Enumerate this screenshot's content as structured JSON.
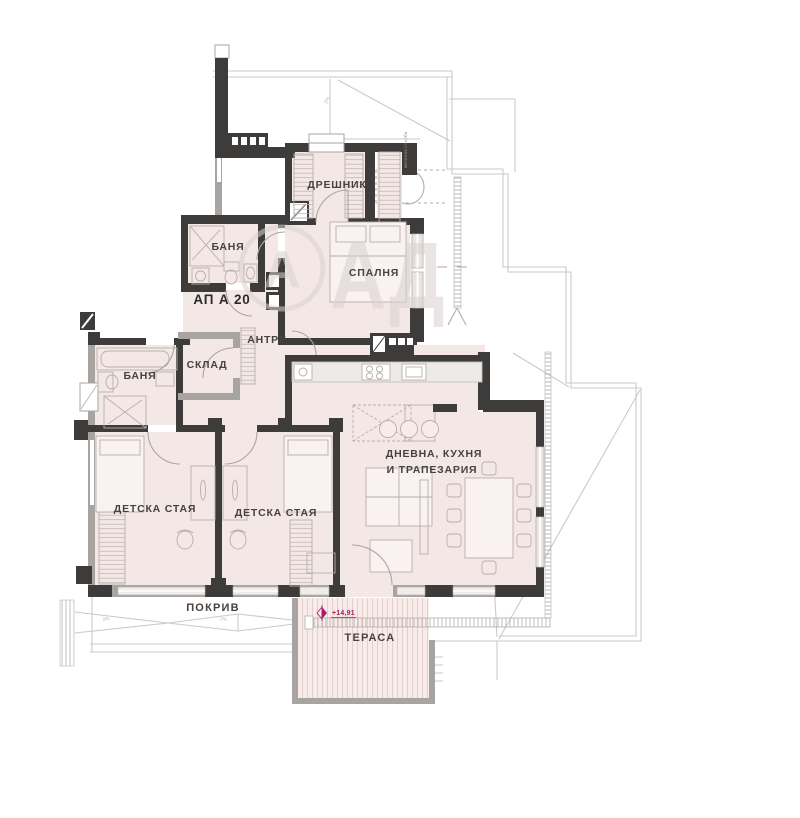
{
  "title": "Апартамент АП А 20 — архитектурен план",
  "colors": {
    "wall_dark": "#3e3c3b",
    "wall_gray": "#a8a4a1",
    "room_fill": "#f4e8e6",
    "terrace_fill": "#f7ece9",
    "roof_line": "#cdc9c6",
    "furniture_line": "#b7aeab",
    "label_text": "#45423f",
    "elevation_magenta": "#ab1a67",
    "watermark": "#d9d1ce"
  },
  "labels": {
    "apartment": "АП А 20",
    "dressing": "ДРЕШНИК",
    "bedroom": "СПАЛНЯ",
    "bath_top": "БАНЯ",
    "bath_left": "БАНЯ",
    "storage": "СКЛАД",
    "hall": "АНТРЕ",
    "kids_left": "ДЕТСКА СТАЯ",
    "kids_right": "ДЕТСКА СТАЯ",
    "living_line1": "ДНЕВНА, КУХНЯ",
    "living_line2": "И ТРАПЕЗАРИЯ",
    "roof": "ПОКРИВ",
    "terrace": "ТЕРАСА",
    "elevation": "+14,91",
    "stair_note": "метална стълба",
    "slope_note": "2%"
  },
  "watermark": {
    "monogram": "А",
    "letters": "АД"
  }
}
